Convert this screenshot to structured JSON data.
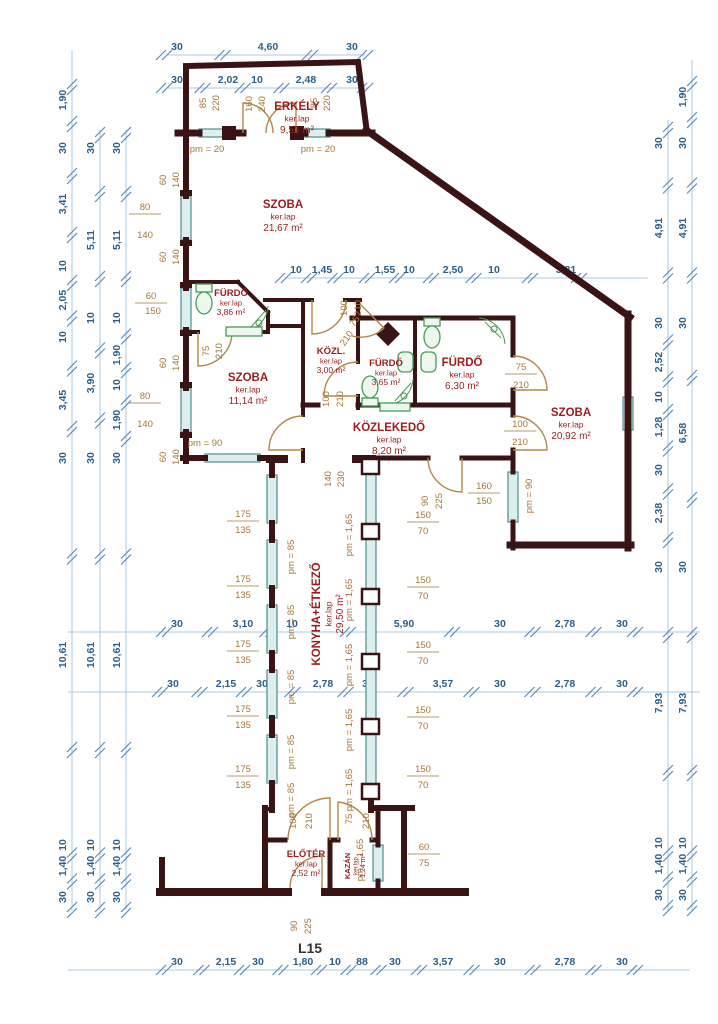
{
  "drawing_title": "L15",
  "colors": {
    "wall": "#3a1414",
    "dim_line": "#a9c8e2",
    "dim_text": "#2b5e8c",
    "minor_text": "#a5763a",
    "room_text": "#9c1c1c",
    "door": "#b08948",
    "fixture": "#4a9a55",
    "window": "#4e8e8e",
    "title_text": "#333333"
  },
  "rooms": [
    {
      "n": "ERKÉLY",
      "f": "ker.lap",
      "a": "9,56 m²",
      "x": 297,
      "y": 110,
      "r": 0,
      "s": 0
    },
    {
      "n": "SZOBA",
      "f": "ker.lap",
      "a": "21,67 m²",
      "x": 283,
      "y": 208,
      "r": 0,
      "s": 0
    },
    {
      "n": "FÜRDŐ",
      "f": "ker.lap",
      "a": "3,86 m²",
      "x": 231,
      "y": 296,
      "r": 0,
      "s": 1
    },
    {
      "n": "KÖZL.",
      "f": "ker.lap",
      "a": "3,00 m²",
      "x": 331,
      "y": 354,
      "r": 0,
      "s": 1
    },
    {
      "n": "FÜRDŐ",
      "f": "ker.lap",
      "a": "3,65 m²",
      "x": 386,
      "y": 366,
      "r": 0,
      "s": 1
    },
    {
      "n": "FÜRDŐ",
      "f": "ker.lap",
      "a": "6,30 m²",
      "x": 462,
      "y": 366,
      "r": 0,
      "s": 0
    },
    {
      "n": "SZOBA",
      "f": "ker.lap",
      "a": "11,14 m²",
      "x": 248,
      "y": 381,
      "r": 0,
      "s": 0
    },
    {
      "n": "SZOBA",
      "f": "ker.lap",
      "a": "20,92 m²",
      "x": 571,
      "y": 416,
      "r": 0,
      "s": 0
    },
    {
      "n": "KÖZLEKEDŐ",
      "f": "ker.lap",
      "a": "8,20 m²",
      "x": 389,
      "y": 431,
      "r": 0,
      "s": 0
    },
    {
      "n": "KONYHA+ÉTKEZŐ",
      "f": "ker.lap",
      "a": "29,50 m²",
      "x": 320,
      "y": 614,
      "r": -90,
      "s": 0
    },
    {
      "n": "ELŐTÉR",
      "f": "ker.lap",
      "a": "2,52 m²",
      "x": 306,
      "y": 857,
      "r": 0,
      "s": 1
    },
    {
      "n": "KAZÁN",
      "f": "ker.lap",
      "a": "1,24 m²",
      "x": 350,
      "y": 866,
      "r": -90,
      "s": 2
    }
  ],
  "dim_chains": [
    {
      "o": "h",
      "p": 55,
      "a": 168,
      "b": 365,
      "L": [
        {
          "t": "30",
          "c": 177
        },
        {
          "t": "4,60",
          "c": 268
        },
        {
          "t": "30",
          "c": 352
        }
      ]
    },
    {
      "o": "h",
      "p": 88,
      "a": 168,
      "b": 368,
      "L": [
        {
          "t": "30",
          "c": 177
        },
        {
          "t": "2,02",
          "c": 228
        },
        {
          "t": "10",
          "c": 257
        },
        {
          "t": "2,48",
          "c": 306
        },
        {
          "t": "30",
          "c": 352
        }
      ]
    },
    {
      "o": "h",
      "p": 278,
      "a": 285,
      "b": 648,
      "L": [
        {
          "t": "10",
          "c": 296
        },
        {
          "t": "1,45",
          "c": 322
        },
        {
          "t": "10",
          "c": 349
        },
        {
          "t": "1,55",
          "c": 385
        },
        {
          "t": "10",
          "c": 409
        },
        {
          "t": "2,50",
          "c": 453
        },
        {
          "t": "10",
          "c": 494
        },
        {
          "t": "3,81",
          "c": 566
        }
      ]
    },
    {
      "o": "h",
      "p": 632,
      "a": 68,
      "b": 700,
      "L": [
        {
          "t": "30",
          "c": 177
        },
        {
          "t": "3,10",
          "c": 243
        },
        {
          "t": "10",
          "c": 292
        },
        {
          "t": "5,90",
          "c": 404
        },
        {
          "t": "30",
          "c": 500
        },
        {
          "t": "2,78",
          "c": 565
        },
        {
          "t": "30",
          "c": 622
        }
      ]
    },
    {
      "o": "h",
      "p": 692,
      "a": 68,
      "b": 700,
      "L": [
        {
          "t": "30",
          "c": 173
        },
        {
          "t": "2,15",
          "c": 226
        },
        {
          "t": "30",
          "c": 262
        },
        {
          "t": "2,78",
          "c": 323
        },
        {
          "t": "30",
          "c": 368
        },
        {
          "t": "3,57",
          "c": 443
        },
        {
          "t": "30",
          "c": 500
        },
        {
          "t": "2,78",
          "c": 565
        },
        {
          "t": "30",
          "c": 622
        }
      ]
    },
    {
      "o": "h",
      "p": 970,
      "a": 68,
      "b": 690,
      "L": [
        {
          "t": "30",
          "c": 177
        },
        {
          "t": "2,15",
          "c": 226
        },
        {
          "t": "30",
          "c": 258
        },
        {
          "t": "1,80",
          "c": 303
        },
        {
          "t": "10",
          "c": 335
        },
        {
          "t": "88",
          "c": 362
        },
        {
          "t": "30",
          "c": 395
        },
        {
          "t": "3,57",
          "c": 443
        },
        {
          "t": "30",
          "c": 500
        },
        {
          "t": "2,78",
          "c": 565
        },
        {
          "t": "30",
          "c": 622
        }
      ]
    },
    {
      "o": "v",
      "p": 72,
      "a": 50,
      "b": 910,
      "L": [
        {
          "t": "1,90",
          "c": 100
        },
        {
          "t": "30",
          "c": 148
        },
        {
          "t": "3,41",
          "c": 204
        },
        {
          "t": "10",
          "c": 266
        },
        {
          "t": "2,05",
          "c": 300
        },
        {
          "t": "10",
          "c": 337
        },
        {
          "t": "3,45",
          "c": 400
        },
        {
          "t": "30",
          "c": 458
        },
        {
          "t": "10,61",
          "c": 655
        },
        {
          "t": "10",
          "c": 845
        },
        {
          "t": "1,40",
          "c": 866
        },
        {
          "t": "30",
          "c": 897
        }
      ]
    },
    {
      "o": "v",
      "p": 100,
      "a": 130,
      "b": 910,
      "L": [
        {
          "t": "30",
          "c": 148
        },
        {
          "t": "5,11",
          "c": 240
        },
        {
          "t": "10",
          "c": 318
        },
        {
          "t": "3,90",
          "c": 383
        },
        {
          "t": "30",
          "c": 458
        },
        {
          "t": "10,61",
          "c": 655
        },
        {
          "t": "10",
          "c": 845
        },
        {
          "t": "1,40",
          "c": 866
        },
        {
          "t": "30",
          "c": 897
        }
      ]
    },
    {
      "o": "v",
      "p": 126,
      "a": 130,
      "b": 910,
      "L": [
        {
          "t": "30",
          "c": 148
        },
        {
          "t": "5,11",
          "c": 240
        },
        {
          "t": "10",
          "c": 318
        },
        {
          "t": "1,90",
          "c": 355
        },
        {
          "t": "10",
          "c": 385
        },
        {
          "t": "1,90",
          "c": 420
        },
        {
          "t": "30",
          "c": 458
        },
        {
          "t": "10,61",
          "c": 655
        },
        {
          "t": "10",
          "c": 845
        },
        {
          "t": "1,40",
          "c": 866
        },
        {
          "t": "30",
          "c": 897
        }
      ]
    },
    {
      "o": "v",
      "p": 668,
      "a": 120,
      "b": 910,
      "L": [
        {
          "t": "30",
          "c": 143
        },
        {
          "t": "4,91",
          "c": 228
        },
        {
          "t": "30",
          "c": 323
        },
        {
          "t": "2,52",
          "c": 362
        },
        {
          "t": "10",
          "c": 397
        },
        {
          "t": "1,28",
          "c": 427
        },
        {
          "t": "30",
          "c": 470
        },
        {
          "t": "2,38",
          "c": 513
        },
        {
          "t": "30",
          "c": 567
        },
        {
          "t": "7,93",
          "c": 703
        },
        {
          "t": "10",
          "c": 843
        },
        {
          "t": "1,40",
          "c": 864
        },
        {
          "t": "30",
          "c": 895
        }
      ]
    },
    {
      "o": "v",
      "p": 692,
      "a": 60,
      "b": 910,
      "L": [
        {
          "t": "1,90",
          "c": 97
        },
        {
          "t": "30",
          "c": 143
        },
        {
          "t": "4,91",
          "c": 228
        },
        {
          "t": "30",
          "c": 323
        },
        {
          "t": "6,58",
          "c": 433
        },
        {
          "t": "30",
          "c": 567
        },
        {
          "t": "7,93",
          "c": 703
        },
        {
          "t": "10",
          "c": 843
        },
        {
          "t": "1,40",
          "c": 864
        },
        {
          "t": "30",
          "c": 895
        }
      ]
    }
  ],
  "annotations": [
    {
      "t": "85",
      "x": 206,
      "y": 103,
      "r": "v"
    },
    {
      "t": "220",
      "x": 219,
      "y": 103,
      "r": "v"
    },
    {
      "t": "160",
      "x": 252,
      "y": 104,
      "r": "v"
    },
    {
      "t": "240",
      "x": 265,
      "y": 104,
      "r": "v"
    },
    {
      "t": "85",
      "x": 317,
      "y": 103,
      "r": "v"
    },
    {
      "t": "220",
      "x": 330,
      "y": 103,
      "r": "v"
    },
    {
      "t": "pm = 20",
      "x": 207,
      "y": 152
    },
    {
      "t": "pm = 20",
      "x": 318,
      "y": 152
    },
    {
      "t": "60",
      "x": 166,
      "y": 180,
      "r": "v"
    },
    {
      "t": "140",
      "x": 179,
      "y": 180,
      "r": "v"
    },
    {
      "t": "80",
      "x": 145,
      "y": 210,
      "bar": 1
    },
    {
      "t": "140",
      "x": 145,
      "y": 238
    },
    {
      "t": "60",
      "x": 166,
      "y": 257,
      "r": "v"
    },
    {
      "t": "140",
      "x": 179,
      "y": 257,
      "r": "v"
    },
    {
      "t": "60",
      "x": 151,
      "y": 299,
      "bar": 1
    },
    {
      "t": "150",
      "x": 153,
      "y": 314
    },
    {
      "t": "60",
      "x": 166,
      "y": 363,
      "r": "v"
    },
    {
      "t": "140",
      "x": 179,
      "y": 363,
      "r": "v"
    },
    {
      "t": "80",
      "x": 145,
      "y": 399,
      "bar": 1
    },
    {
      "t": "140",
      "x": 145,
      "y": 427
    },
    {
      "t": "60",
      "x": 166,
      "y": 457,
      "r": "v"
    },
    {
      "t": "140",
      "x": 179,
      "y": 457,
      "r": "v"
    },
    {
      "t": "pm = 90",
      "x": 205,
      "y": 446
    },
    {
      "t": "75",
      "x": 209,
      "y": 351,
      "r": "v"
    },
    {
      "t": "210",
      "x": 222,
      "y": 351,
      "r": "v"
    },
    {
      "t": "100",
      "x": 347,
      "y": 308,
      "r": "v"
    },
    {
      "t": "210",
      "x": 361,
      "y": 308,
      "r": "v"
    },
    {
      "t": "75",
      "x": 357,
      "y": 323,
      "r": "d"
    },
    {
      "t": "210",
      "x": 349,
      "y": 340,
      "r": "d"
    },
    {
      "t": "100",
      "x": 329,
      "y": 399,
      "r": "v"
    },
    {
      "t": "210",
      "x": 343,
      "y": 399,
      "r": "v"
    },
    {
      "t": "75",
      "x": 521,
      "y": 370,
      "bar": 1
    },
    {
      "t": "210",
      "x": 521,
      "y": 388
    },
    {
      "t": "100",
      "x": 520,
      "y": 427,
      "bar": 1
    },
    {
      "t": "210",
      "x": 520,
      "y": 445
    },
    {
      "t": "140",
      "x": 331,
      "y": 479,
      "r": "v"
    },
    {
      "t": "230",
      "x": 344,
      "y": 479,
      "r": "v"
    },
    {
      "t": "90",
      "x": 428,
      "y": 501,
      "r": "v"
    },
    {
      "t": "225",
      "x": 442,
      "y": 501,
      "r": "v"
    },
    {
      "t": "160",
      "x": 484,
      "y": 489,
      "bar": 1
    },
    {
      "t": "150",
      "x": 484,
      "y": 504
    },
    {
      "t": "pm = 90",
      "x": 532,
      "y": 496,
      "r": "v"
    },
    {
      "t": "175",
      "x": 243,
      "y": 517,
      "bar": 1
    },
    {
      "t": "135",
      "x": 243,
      "y": 533
    },
    {
      "t": "175",
      "x": 243,
      "y": 582,
      "bar": 1
    },
    {
      "t": "135",
      "x": 243,
      "y": 598
    },
    {
      "t": "175",
      "x": 243,
      "y": 647,
      "bar": 1
    },
    {
      "t": "135",
      "x": 243,
      "y": 663
    },
    {
      "t": "175",
      "x": 243,
      "y": 712,
      "bar": 1
    },
    {
      "t": "135",
      "x": 243,
      "y": 728
    },
    {
      "t": "175",
      "x": 243,
      "y": 772,
      "bar": 1
    },
    {
      "t": "135",
      "x": 243,
      "y": 788
    },
    {
      "t": "pm = 85",
      "x": 294,
      "y": 557,
      "r": "v"
    },
    {
      "t": "pm = 85",
      "x": 294,
      "y": 622,
      "r": "v"
    },
    {
      "t": "pm = 85",
      "x": 294,
      "y": 687,
      "r": "v"
    },
    {
      "t": "pm = 85",
      "x": 294,
      "y": 752,
      "r": "v"
    },
    {
      "t": "pm = 85",
      "x": 294,
      "y": 800,
      "r": "v"
    },
    {
      "t": "pm = 1,65",
      "x": 352,
      "y": 535,
      "r": "v"
    },
    {
      "t": "pm = 1,65",
      "x": 352,
      "y": 600,
      "r": "v"
    },
    {
      "t": "pm = 1,65",
      "x": 352,
      "y": 665,
      "r": "v"
    },
    {
      "t": "pm = 1,65",
      "x": 352,
      "y": 730,
      "r": "v"
    },
    {
      "t": "pm = 1,65",
      "x": 352,
      "y": 790,
      "r": "v"
    },
    {
      "t": "150",
      "x": 423,
      "y": 518,
      "bar": 1
    },
    {
      "t": "70",
      "x": 423,
      "y": 534
    },
    {
      "t": "150",
      "x": 423,
      "y": 583,
      "bar": 1
    },
    {
      "t": "70",
      "x": 423,
      "y": 599
    },
    {
      "t": "150",
      "x": 423,
      "y": 648,
      "bar": 1
    },
    {
      "t": "70",
      "x": 423,
      "y": 664
    },
    {
      "t": "150",
      "x": 423,
      "y": 713,
      "bar": 1
    },
    {
      "t": "70",
      "x": 423,
      "y": 729
    },
    {
      "t": "150",
      "x": 423,
      "y": 772,
      "bar": 1
    },
    {
      "t": "70",
      "x": 423,
      "y": 788
    },
    {
      "t": "100",
      "x": 296,
      "y": 821,
      "r": "v"
    },
    {
      "t": "210",
      "x": 312,
      "y": 821,
      "r": "v"
    },
    {
      "t": "75",
      "x": 352,
      "y": 819,
      "r": "v"
    },
    {
      "t": "210",
      "x": 369,
      "y": 821,
      "r": "v"
    },
    {
      "t": "pm = 1,65",
      "x": 363,
      "y": 860,
      "r": "v"
    },
    {
      "t": "60",
      "x": 424,
      "y": 850,
      "bar": 1
    },
    {
      "t": "75",
      "x": 424,
      "y": 866
    },
    {
      "t": "90",
      "x": 297,
      "y": 926,
      "r": "v"
    },
    {
      "t": "225",
      "x": 311,
      "y": 926,
      "r": "v"
    }
  ],
  "title_label": {
    "t": "L15",
    "x": 310,
    "y": 953
  }
}
